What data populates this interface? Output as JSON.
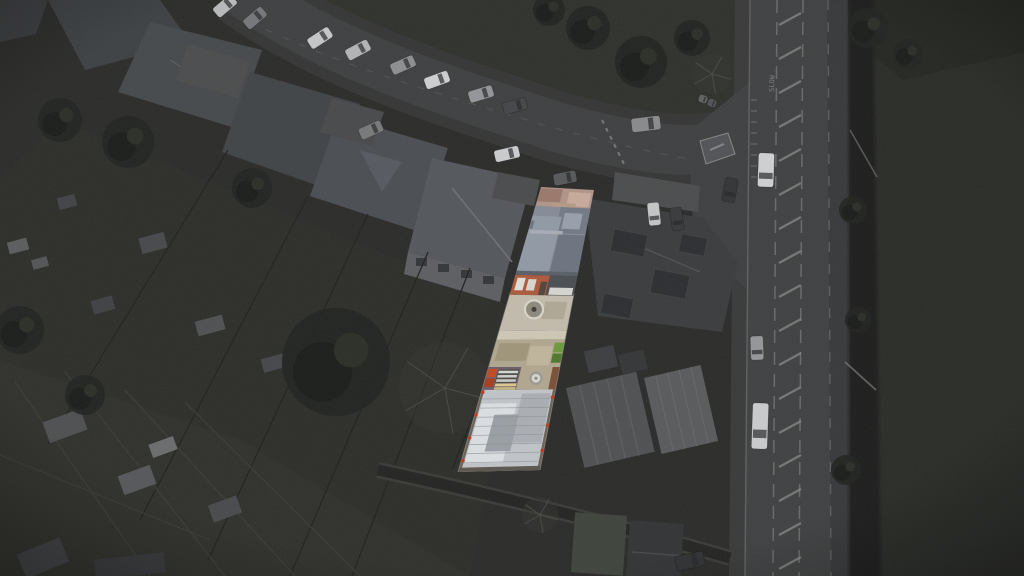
{
  "scene": {
    "type": "aerial-drone-photograph",
    "caption": "Aerial drone view of a residential neighbourhood at dusk-dark grading; one terraced property and its long narrow rear plot are highlighted in full colour while all surroundings are desaturated dark grey. A main road with hatched centre markings runs down the right side beside a hedge and a large dark playing field; a curving residential street with parked cars crosses the top.",
    "highlight_effect": "surroundings desaturated and darkened; subject property in full colour"
  },
  "palette": {
    "background": "#2a2a29",
    "main_road": "#3f4041",
    "street": "#3e3f40",
    "pavement": "#38393a",
    "road_marking": "#8c8d8c",
    "hedge": "#1d1f1b",
    "field": "#292b27",
    "green_space": "#2e302b",
    "tree_canopy": "#212320",
    "garden": "#2c2d29",
    "allotment": "#2f2f2b",
    "roof_dark": "#404347",
    "roof_light": "#54575c",
    "strip_front_garden": "#b1958a",
    "strip_slate_roof": "#868c98",
    "strip_brick": "#ad5a3c",
    "strip_patio": "#c4bdae",
    "strip_gravel": "#b2a891",
    "strip_bin_green": "#6e9a3b",
    "strip_crate_red": "#c24a21",
    "strip_pallet_cream": "#ddcb90",
    "strip_shed_purple": "#6b5e6d",
    "strip_outbuilding_roof": "#c2c6ca"
  },
  "road": {
    "slow_text": "SLOW",
    "hatch": {
      "cx": 790,
      "half": 11,
      "y0": 14,
      "y1": 566,
      "step": 34
    },
    "boundary_dash_x": [
      777,
      803
    ],
    "edge_left": [
      750,
      0,
      745,
      576
    ],
    "edge_right": [
      828,
      0,
      831,
      576
    ]
  },
  "strip": {
    "quad": {
      "tl": [
        541,
        187
      ],
      "tr": [
        594,
        190
      ],
      "br": [
        540,
        470
      ],
      "bl": [
        458,
        472
      ]
    },
    "bands": [
      {
        "name": "front-garden",
        "t0": 0,
        "t1": 0.085,
        "u0": 0,
        "u1": 1,
        "fill": "#b1958a"
      },
      {
        "name": "front-garden-patch-a",
        "t0": 0.004,
        "t1": 0.05,
        "u0": 0,
        "u1": 0.42,
        "fill": "#9a7a6c"
      },
      {
        "name": "front-garden-patch-b",
        "t0": 0.012,
        "t1": 0.062,
        "u0": 0.55,
        "u1": 0.96,
        "fill": "#c9ab9c"
      },
      {
        "name": "front-garden-patch-c",
        "t0": 0.052,
        "t1": 0.082,
        "u0": 0.28,
        "u1": 0.72,
        "fill": "#b69b86"
      },
      {
        "name": "house-roof",
        "t0": 0.066,
        "t1": 0.302,
        "u0": 0,
        "u1": 1,
        "fill": "#868c98"
      },
      {
        "name": "roof-front-hip",
        "t0": 0.066,
        "t1": 0.158,
        "u0": 0.46,
        "u1": 1,
        "fill": "#747a86"
      },
      {
        "name": "roof-front-gable",
        "t0": 0.086,
        "t1": 0.142,
        "u0": 0.56,
        "u1": 0.88,
        "fill": "#99a0ac"
      },
      {
        "name": "roof-left-face",
        "t0": 0.1,
        "t1": 0.292,
        "u0": 0,
        "u1": 0.52,
        "fill": "#929aa6"
      },
      {
        "name": "roof-right-face",
        "t0": 0.162,
        "t1": 0.3,
        "u0": 0.54,
        "u1": 1,
        "fill": "#6d7380"
      },
      {
        "name": "roof-ridge",
        "t0": 0.15,
        "t1": 0.162,
        "u0": 0.03,
        "u1": 0.6,
        "fill": "#a9aeb8"
      },
      {
        "name": "roof-chimney",
        "t0": 0.118,
        "t1": 0.146,
        "u0": 0,
        "u1": 0.06,
        "fill": "#6f7580"
      },
      {
        "name": "roof-eaves-shadow",
        "t0": 0.294,
        "t1": 0.308,
        "u0": 0,
        "u1": 1,
        "fill": "#5a5f68"
      },
      {
        "name": "rear-facade-brick",
        "t0": 0.308,
        "t1": 0.378,
        "u0": 0,
        "u1": 0.56,
        "fill": "#ad5a3c"
      },
      {
        "name": "facade-window-a",
        "t0": 0.318,
        "t1": 0.362,
        "u0": 0.05,
        "u1": 0.18,
        "fill": "#e2e1da"
      },
      {
        "name": "facade-window-b",
        "t0": 0.322,
        "t1": 0.362,
        "u0": 0.23,
        "u1": 0.36,
        "fill": "#d9d8d1"
      },
      {
        "name": "facade-door",
        "t0": 0.33,
        "t1": 0.378,
        "u0": 0.44,
        "u1": 0.54,
        "fill": "#50443b"
      },
      {
        "name": "rear-extension-flat-roof",
        "t0": 0.308,
        "t1": 0.378,
        "u0": 0.56,
        "u1": 1,
        "fill": "#4a4e53"
      },
      {
        "name": "extension-window-band",
        "t0": 0.35,
        "t1": 0.376,
        "u0": 0.6,
        "u1": 0.97,
        "fill": "#d7d8d2"
      },
      {
        "name": "patio",
        "t0": 0.378,
        "t1": 0.502,
        "u0": 0,
        "u1": 1,
        "fill": "#c4bdae"
      },
      {
        "name": "patio-shading",
        "t0": 0.4,
        "t1": 0.462,
        "u0": 0.58,
        "u1": 0.92,
        "fill": "#b2a997"
      },
      {
        "name": "patio-step",
        "t0": 0.502,
        "t1": 0.535,
        "u0": 0,
        "u1": 1,
        "fill": "#d0c9b7"
      },
      {
        "name": "step-notch",
        "t0": 0.528,
        "t1": 0.562,
        "u0": 0.36,
        "u1": 0.56,
        "fill": "#c8c1af"
      },
      {
        "name": "gravel-garden",
        "t0": 0.535,
        "t1": 0.632,
        "u0": 0,
        "u1": 1,
        "fill": "#b2a891"
      },
      {
        "name": "gravel-dark-patch",
        "t0": 0.548,
        "t1": 0.61,
        "u0": 0.06,
        "u1": 0.5,
        "fill": "#a1967b"
      },
      {
        "name": "gravel-light-patch",
        "t0": 0.558,
        "t1": 0.626,
        "u0": 0.52,
        "u1": 0.84,
        "fill": "#c1b79d"
      },
      {
        "name": "green-bin-a",
        "t0": 0.545,
        "t1": 0.58,
        "u0": 0.86,
        "u1": 1,
        "fill": "#6e9a3b"
      },
      {
        "name": "green-bin-b",
        "t0": 0.584,
        "t1": 0.617,
        "u0": 0.86,
        "u1": 1,
        "fill": "#4e7a2b"
      },
      {
        "name": "storage-ground",
        "t0": 0.632,
        "t1": 0.712,
        "u0": 0.44,
        "u1": 1,
        "fill": "#b3a78f"
      },
      {
        "name": "shed-purple-roof",
        "t0": 0.632,
        "t1": 0.712,
        "u0": 0,
        "u1": 0.46,
        "fill": "#6b5e6d"
      },
      {
        "name": "red-crate-a",
        "t0": 0.638,
        "t1": 0.668,
        "u0": 0.01,
        "u1": 0.135,
        "fill": "#c24a21"
      },
      {
        "name": "red-crate-b",
        "t0": 0.672,
        "t1": 0.702,
        "u0": 0.01,
        "u1": 0.135,
        "fill": "#a93d1c"
      },
      {
        "name": "pallet-stack-dark",
        "t0": 0.64,
        "t1": 0.688,
        "u0": 0.15,
        "u1": 0.44,
        "fill": "#4c4b46"
      },
      {
        "name": "pallet-stripe-a",
        "t0": 0.645,
        "t1": 0.654,
        "u0": 0.16,
        "u1": 0.43,
        "fill": "#d8d8d6"
      },
      {
        "name": "pallet-stripe-b",
        "t0": 0.66,
        "t1": 0.669,
        "u0": 0.16,
        "u1": 0.43,
        "fill": "#d1d1cf"
      },
      {
        "name": "pallet-stripe-c",
        "t0": 0.675,
        "t1": 0.684,
        "u0": 0.16,
        "u1": 0.43,
        "fill": "#cbcbc9"
      },
      {
        "name": "cream-pallet-a",
        "t0": 0.69,
        "t1": 0.7,
        "u0": 0.16,
        "u1": 0.45,
        "fill": "#ddcb90"
      },
      {
        "name": "cream-pallet-b",
        "t0": 0.703,
        "t1": 0.712,
        "u0": 0.16,
        "u1": 0.45,
        "fill": "#cdbb7e"
      },
      {
        "name": "storage-right-border",
        "t0": 0.632,
        "t1": 0.712,
        "u0": 0.9,
        "u1": 1,
        "fill": "#7a5036"
      },
      {
        "name": "outbuilding-roof",
        "t0": 0.712,
        "t1": 1,
        "u0": 0,
        "u1": 1,
        "fill": "#c2c6ca"
      },
      {
        "name": "outbuilding-sheen",
        "t0": 0.76,
        "t1": 0.97,
        "u0": 0.05,
        "u1": 0.52,
        "fill": "#dde1e4"
      },
      {
        "name": "outbuilding-dull",
        "t0": 0.726,
        "t1": 0.9,
        "u0": 0.56,
        "u1": 0.95,
        "fill": "#abb0b5"
      },
      {
        "name": "outbuilding-shadow-patch",
        "t0": 0.8,
        "t1": 0.93,
        "u0": 0.26,
        "u1": 0.58,
        "fill": "#9ba0a6"
      },
      {
        "name": "outbuilding-left-edge",
        "t0": 0.712,
        "t1": 1,
        "u0": 0,
        "u1": 0.035,
        "fill": "#6b6257"
      },
      {
        "name": "outbuilding-right-edge",
        "t0": 0.712,
        "t1": 1,
        "u0": 0.965,
        "u1": 1,
        "fill": "#6b6257"
      },
      {
        "name": "outbuilding-bottom-edge",
        "t0": 0.985,
        "t1": 1,
        "u0": 0,
        "u1": 1,
        "fill": "#5b564e"
      }
    ],
    "circles": [
      {
        "name": "patio-ornament",
        "t": 0.428,
        "u": 0.436,
        "r": 9,
        "fill": "#8d897d",
        "stroke": "#dad7cd",
        "dot": "#3f3c36"
      },
      {
        "name": "garden-table",
        "t": 0.672,
        "u": 0.7,
        "r": 5.5,
        "fill": "#d8d8d3",
        "stroke": "#9a9a94",
        "dot": "#8b8b85"
      }
    ],
    "seam_ts": [
      0.744,
      0.776,
      0.808,
      0.84,
      0.872,
      0.904,
      0.936,
      0.968
    ],
    "red_dots": [
      {
        "t": 0.72,
        "u": 0.02
      },
      {
        "t": 0.8,
        "u": 0.015
      },
      {
        "t": 0.88,
        "u": 0.02
      },
      {
        "t": 0.96,
        "u": 0.02
      },
      {
        "t": 0.74,
        "u": 0.98
      },
      {
        "t": 0.84,
        "u": 0.985
      },
      {
        "t": 0.93,
        "u": 0.98
      }
    ],
    "red_dot_color": "#c03a1e"
  },
  "cars": [
    {
      "x": 225,
      "y": 6,
      "w": 24,
      "h": 12,
      "rot": -40,
      "body": "#b9bbbc"
    },
    {
      "x": 255,
      "y": 18,
      "w": 24,
      "h": 12,
      "rot": -40,
      "body": "#74767a"
    },
    {
      "x": 320,
      "y": 38,
      "w": 25,
      "h": 12,
      "rot": -33,
      "body": "#c7c8c9"
    },
    {
      "x": 358,
      "y": 50,
      "w": 25,
      "h": 12,
      "rot": -28,
      "body": "#b4b5b7"
    },
    {
      "x": 403,
      "y": 65,
      "w": 25,
      "h": 12,
      "rot": -24,
      "body": "#8d8f91"
    },
    {
      "x": 437,
      "y": 80,
      "w": 25,
      "h": 12,
      "rot": -20,
      "body": "#d0d1d2"
    },
    {
      "x": 481,
      "y": 94,
      "w": 25,
      "h": 12,
      "rot": -17,
      "body": "#94969a"
    },
    {
      "x": 515,
      "y": 106,
      "w": 24,
      "h": 12,
      "rot": -15,
      "body": "#434548"
    },
    {
      "x": 371,
      "y": 130,
      "w": 24,
      "h": 12,
      "rot": -24,
      "body": "#77797b"
    },
    {
      "x": 507,
      "y": 154,
      "w": 25,
      "h": 12,
      "rot": -13,
      "body": "#cdced0"
    },
    {
      "x": 565,
      "y": 178,
      "w": 23,
      "h": 12,
      "rot": -11,
      "body": "#56585a"
    },
    {
      "x": 646,
      "y": 124,
      "w": 29,
      "h": 14,
      "rot": -7,
      "body": "#898b8d"
    },
    {
      "x": 654,
      "y": 214,
      "w": 23,
      "h": 12,
      "rot": 84,
      "body": "#c6c7c8"
    },
    {
      "x": 677,
      "y": 219,
      "w": 23,
      "h": 12,
      "rot": 82,
      "body": "#37393b"
    },
    {
      "x": 730,
      "y": 190,
      "w": 24,
      "h": 13,
      "rot": 100,
      "body": "#323436"
    },
    {
      "x": 766,
      "y": 170,
      "w": 34,
      "h": 16,
      "rot": 92,
      "body": "#d1d2d3"
    },
    {
      "x": 757,
      "y": 348,
      "w": 24,
      "h": 13,
      "rot": 88,
      "body": "#95979a"
    },
    {
      "x": 760,
      "y": 426,
      "w": 46,
      "h": 16,
      "rot": 92,
      "body": "#cbcdce"
    },
    {
      "x": 690,
      "y": 561,
      "w": 29,
      "h": 15,
      "rot": -12,
      "body": "#2e3032"
    },
    {
      "x": 703,
      "y": 99,
      "w": 9,
      "h": 8,
      "rot": 20,
      "body": "#5e6062"
    },
    {
      "x": 712,
      "y": 103,
      "w": 9,
      "h": 8,
      "rot": 20,
      "body": "#515356"
    }
  ],
  "trees": [
    {
      "x": 336,
      "y": 362,
      "r": 54,
      "type": "leafy"
    },
    {
      "x": 445,
      "y": 388,
      "r": 46,
      "type": "bare"
    },
    {
      "x": 128,
      "y": 142,
      "r": 26,
      "type": "leafy"
    },
    {
      "x": 252,
      "y": 188,
      "r": 20,
      "type": "leafy"
    },
    {
      "x": 60,
      "y": 120,
      "r": 22,
      "type": "leafy"
    },
    {
      "x": 588,
      "y": 28,
      "r": 22,
      "type": "leafy"
    },
    {
      "x": 641,
      "y": 62,
      "r": 26,
      "type": "leafy"
    },
    {
      "x": 692,
      "y": 38,
      "r": 18,
      "type": "leafy"
    },
    {
      "x": 549,
      "y": 10,
      "r": 16,
      "type": "leafy"
    },
    {
      "x": 712,
      "y": 74,
      "r": 20,
      "type": "bare"
    },
    {
      "x": 868,
      "y": 28,
      "r": 20,
      "type": "leafy"
    },
    {
      "x": 908,
      "y": 54,
      "r": 15,
      "type": "leafy"
    },
    {
      "x": 853,
      "y": 210,
      "r": 14,
      "type": "leafy"
    },
    {
      "x": 858,
      "y": 320,
      "r": 13,
      "type": "leafy"
    },
    {
      "x": 846,
      "y": 470,
      "r": 15,
      "type": "leafy"
    },
    {
      "x": 20,
      "y": 330,
      "r": 24,
      "type": "leafy"
    },
    {
      "x": 85,
      "y": 395,
      "r": 20,
      "type": "leafy"
    },
    {
      "x": 540,
      "y": 515,
      "r": 18,
      "type": "bare"
    }
  ]
}
